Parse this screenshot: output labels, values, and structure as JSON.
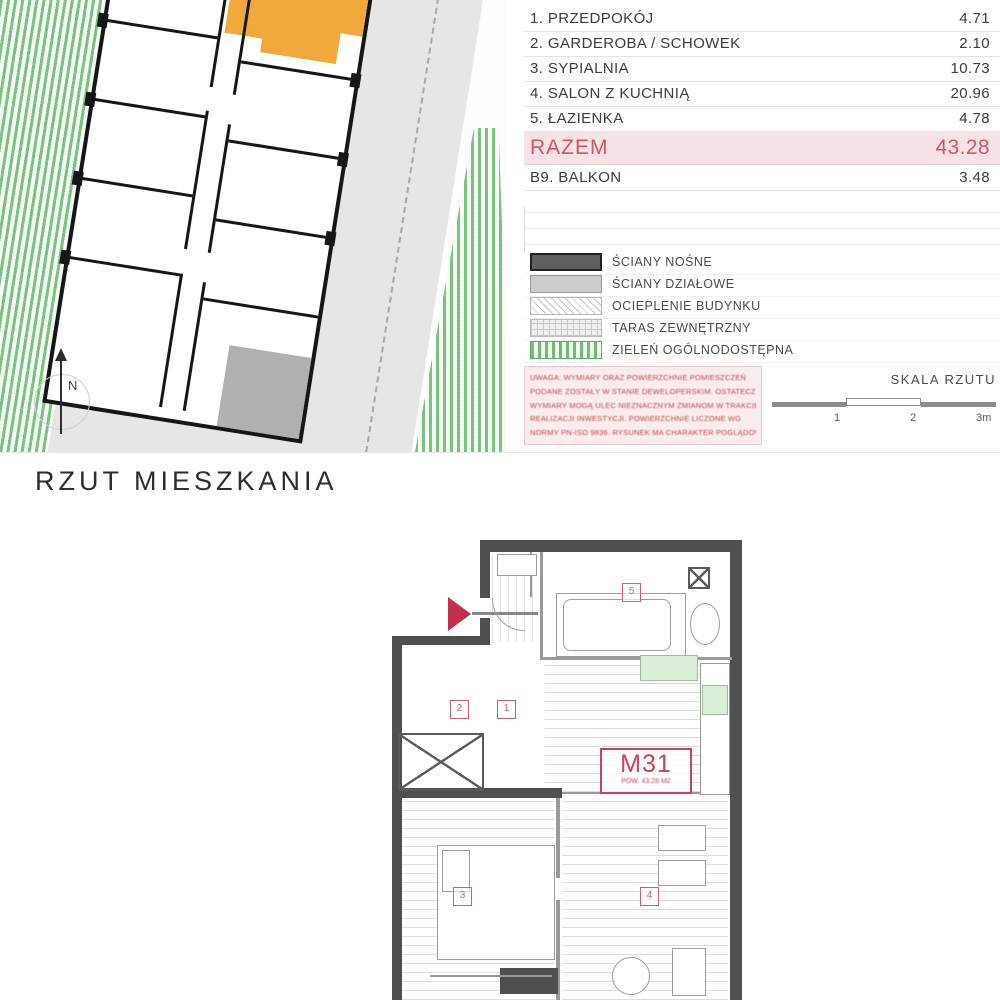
{
  "colors": {
    "accent_red": "#c94450",
    "orange": "#f2a93c",
    "green": "#6cbf6f",
    "wall": "#4e504f",
    "total_pink": "#f7e3e5"
  },
  "site_plan": {
    "north_label": "N"
  },
  "area_table": {
    "header_room": "POMIESZCZENIE",
    "header_area": "POW. [M2]",
    "rows": [
      {
        "label": "1. PRZEDPOKÓJ",
        "value": "4.71"
      },
      {
        "label": "2. GARDEROBA / SCHOWEK",
        "value": "2.10"
      },
      {
        "label": "3. SYPIALNIA",
        "value": "10.73"
      },
      {
        "label": "4. SALON Z KUCHNIĄ",
        "value": "20.96"
      },
      {
        "label": "5. ŁAZIENKA",
        "value": "4.78"
      }
    ],
    "total_label": "RAZEM",
    "total_value": "43.28",
    "balcony_label": "B9. BALKON",
    "balcony_value": "3.48"
  },
  "legend": {
    "items": [
      {
        "label": "ŚCIANY NOŚNE"
      },
      {
        "label": "ŚCIANY DZIAŁOWE"
      },
      {
        "label": "OCIEPLENIE BUDYNKU"
      },
      {
        "label": "TARAS ZEWNĘTRZNY"
      },
      {
        "label": "ZIELEŃ OGÓLNODOSTĘPNA"
      }
    ]
  },
  "disclaimer": {
    "lines": [
      "UWAGA: WYMIARY ORAZ POWIERZCHNIE POMIESZCZEŃ",
      "PODANE ZOSTAŁY W STANIE DEWELOPERSKIM. OSTATECZNE",
      "WYMIARY MOGĄ ULEC NIEZNACZNYM ZMIANOM W TRAKCIE",
      "REALIZACJI INWESTYCJI. POWIERZCHNIE LICZONE WG",
      "NORMY PN-ISO 9836. RYSUNEK MA CHARAKTER POGLĄDOWY."
    ]
  },
  "scale_bar": {
    "title": "SKALA RZUTU",
    "tick1": "1",
    "tick2": "2",
    "tick3": "3m"
  },
  "plan": {
    "title": "RZUT MIESZKANIA",
    "unit": "M31",
    "unit_sub": "POW. 43.28 M2",
    "markers": [
      "1",
      "2",
      "3",
      "4",
      "5"
    ]
  }
}
